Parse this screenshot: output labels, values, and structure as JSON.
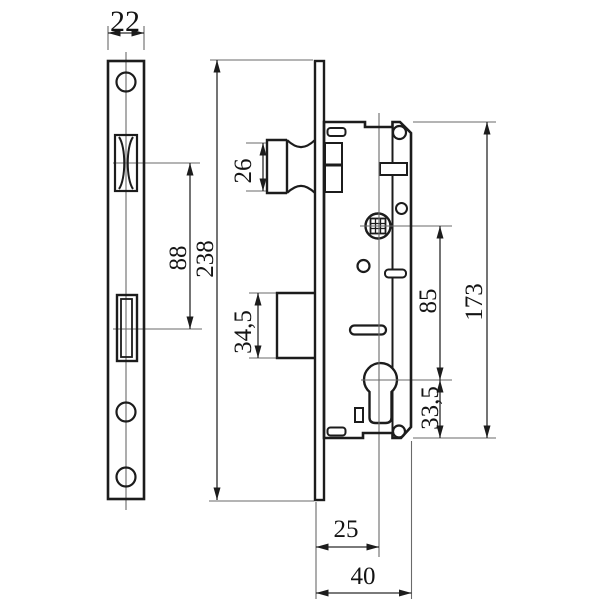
{
  "drawing": {
    "type": "technical-dimension-drawing",
    "subject": "mortise-lock",
    "line_color": "#1c1c1c",
    "thin_line_color": "#6a6a6a",
    "background": "#ffffff"
  },
  "dimensions": {
    "faceplate_width": "22",
    "latch_height": "26",
    "latch_to_deadbolt_centers": "88",
    "faceplate_length": "238",
    "deadbolt_height": "34,5",
    "follower_to_cylinder": "85",
    "case_height": "173",
    "cylinder_to_case_bottom": "33,5",
    "backset": "25",
    "case_depth": "40"
  }
}
